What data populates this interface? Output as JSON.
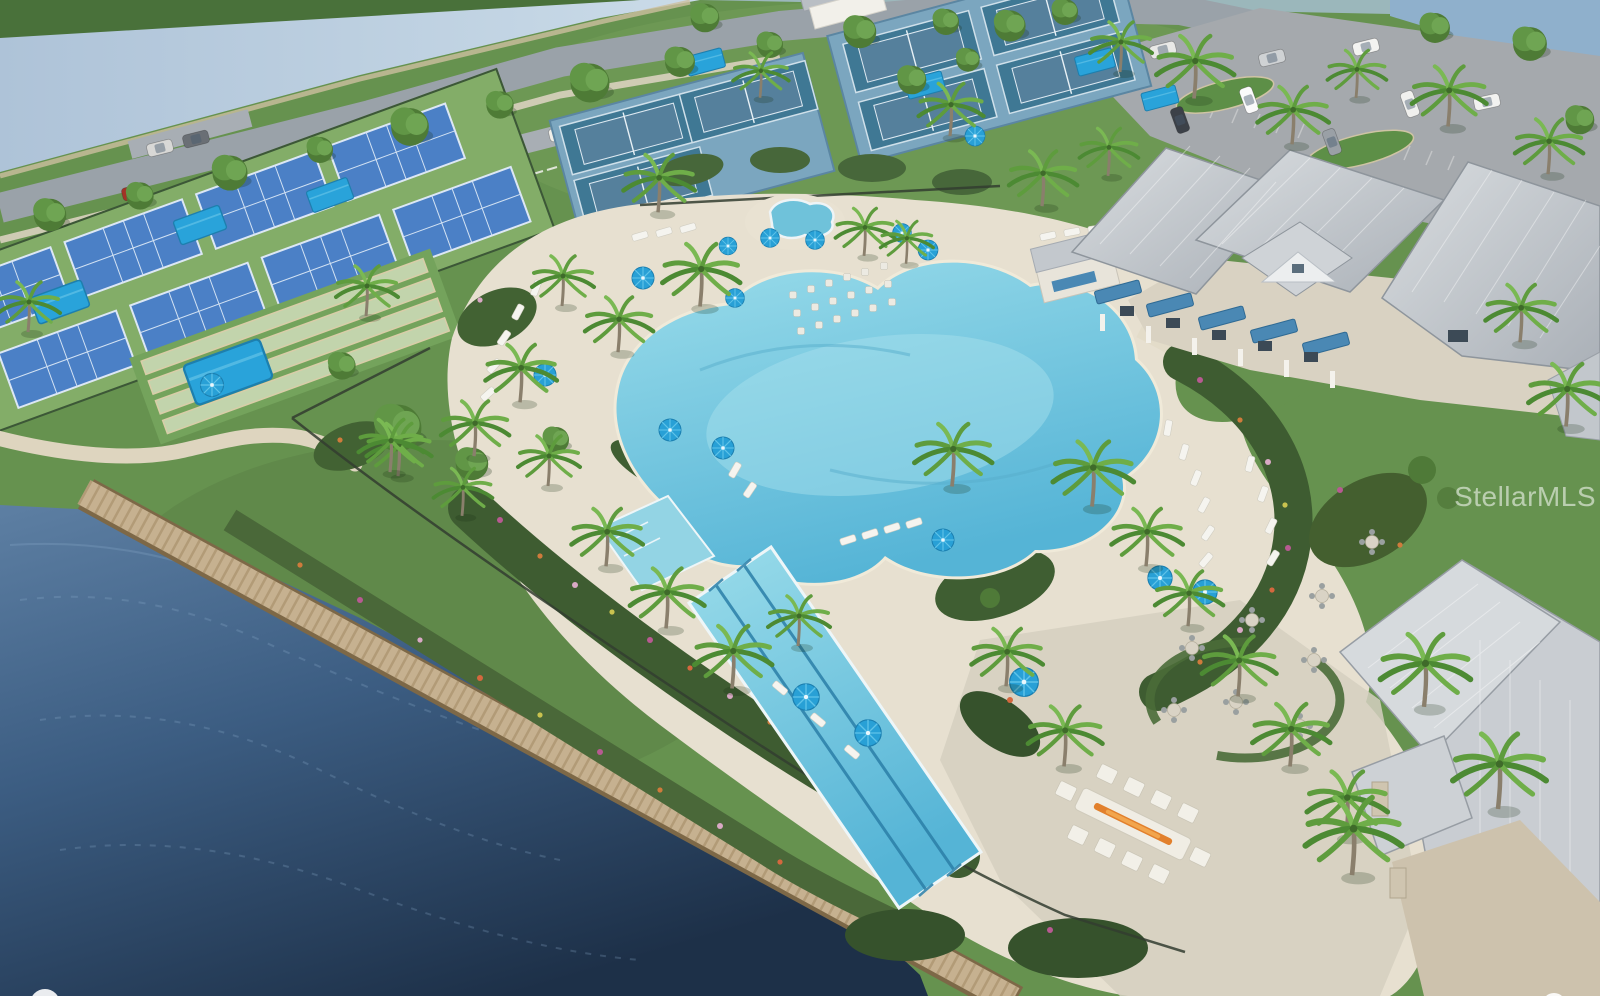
{
  "watermark": {
    "text": "StellarMLS",
    "color": "#ffffff",
    "opacity": 0.55
  },
  "scene": {
    "type": "aerial-3d-rendering",
    "subject": "resort-style community amenity campus",
    "features": [
      "lagoon swimming pool with lap lanes",
      "spa hot tub",
      "paver pool deck with white loungers and blue umbrellas",
      "clubhouse with gray metal hip roofs, blue awnings and white columns",
      "pickleball courts with shade canopies",
      "tennis courts",
      "bocce courts",
      "restroom building",
      "parking lot with cars",
      "tree-lined access road",
      "canal water band",
      "lake with wooden boardwalk",
      "fire pit lounge",
      "outdoor dining terrace",
      "palm trees and landscape beds"
    ]
  },
  "colors": {
    "grass": "#66924f",
    "grass-dark": "#49713a",
    "canal": "#b9cddf",
    "lake-light": "#5d7fa3",
    "lake-deep": "#22364e",
    "pool": "#7ccadf",
    "pool-light": "#abe2ee",
    "deck": "#e7e0d0",
    "stone-patio": "#d5cfc0",
    "road": "#9aa2a9",
    "sidewalk": "#d9d2bf",
    "parking": "#a5a9ad",
    "pickleball-court": "#4b80c6",
    "court-green": "#83ad68",
    "tennis-court": "#3f7894",
    "tennis-apron": "#7ba6bf",
    "bocce-lane": "#c2d4ac",
    "canopy": "#29a3da",
    "umbrella": "#28a0d6",
    "roof": "#ccd0d5",
    "roof-shade": "#aeb4bb",
    "awning": "#4a88b4",
    "boardwalk": "#c6b190",
    "planting": "#3e5c31",
    "stone": "#cdc2ad",
    "fire": "#e2802c"
  }
}
